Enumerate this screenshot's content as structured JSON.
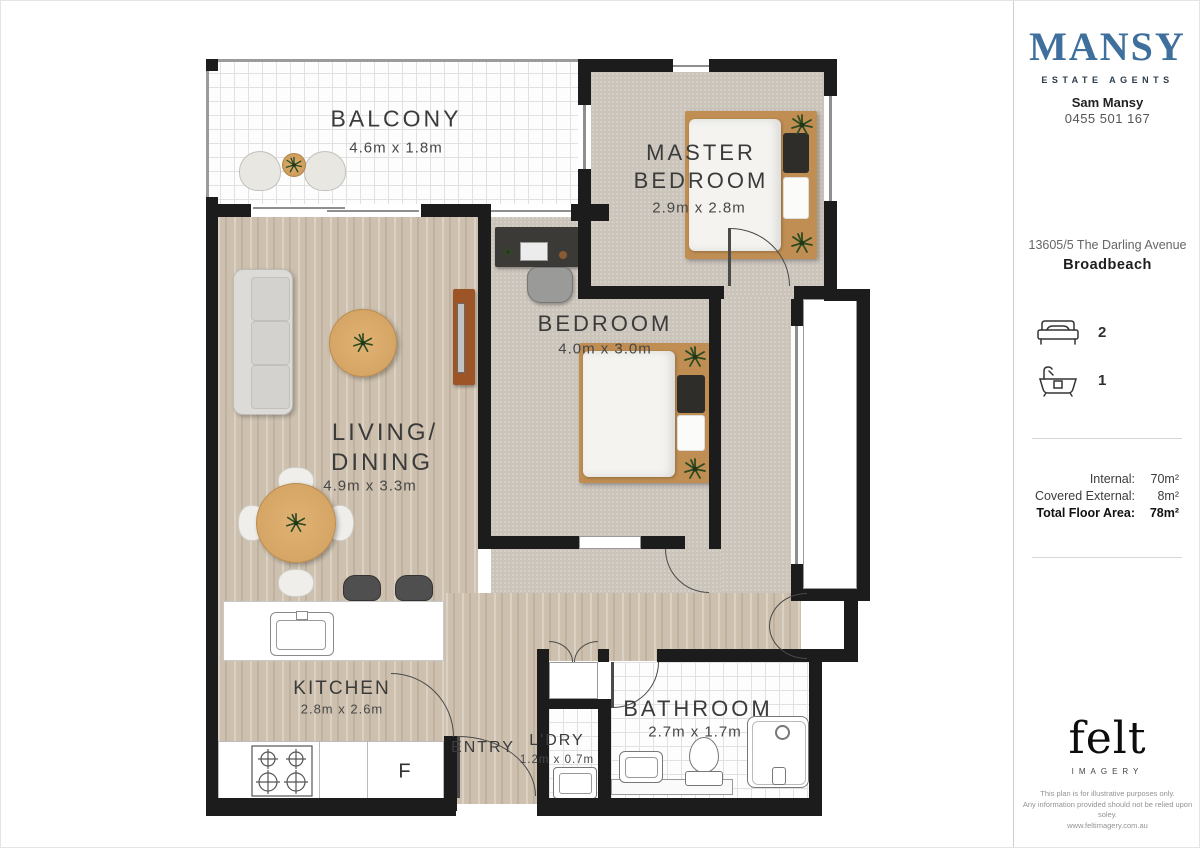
{
  "plan": {
    "rooms": {
      "balcony": {
        "name": "BALCONY",
        "dims": "4.6m x 1.8m"
      },
      "master_bedroom": {
        "name_line1": "MASTER",
        "name_line2": "BEDROOM",
        "dims": "2.9m x 2.8m"
      },
      "bedroom": {
        "name": "BEDROOM",
        "dims": "4.0m x 3.0m"
      },
      "living_dining": {
        "name_line1": "LIVING/",
        "name_line2": "DINING",
        "dims": "4.9m x 3.3m"
      },
      "kitchen": {
        "name": "KITCHEN",
        "dims": "2.8m x 2.6m"
      },
      "entry": {
        "name": "ENTRY"
      },
      "laundry": {
        "name": "L'DRY",
        "dims": "1.2m x 0.7m"
      },
      "bathroom": {
        "name": "BATHROOM",
        "dims": "2.7m x 1.7m"
      }
    },
    "appliances": {
      "fridge_label": "F"
    }
  },
  "sidebar": {
    "brand": {
      "name": "MANSY",
      "tagline": "ESTATE AGENTS"
    },
    "agent": {
      "name": "Sam Mansy",
      "phone": "0455 501 167"
    },
    "listing": {
      "address_line1": "13605/5 The Darling Avenue",
      "suburb": "Broadbeach"
    },
    "features": {
      "bedrooms": "2",
      "bathrooms": "1"
    },
    "areas": {
      "internal_label": "Internal:",
      "internal_value": "70m²",
      "external_label": "Covered External:",
      "external_value": "8m²",
      "total_label": "Total Floor Area:",
      "total_value": "78m²"
    },
    "credit": {
      "logo": "felt",
      "logo_sub": "IMAGERY",
      "disclaimer_line1": "This plan is for illustrative purposes only.",
      "disclaimer_line2": "Any information provided should not be relied upon soley.",
      "website": "www.feltimagery.com.au"
    },
    "colors": {
      "brand_blue": "#3f6f9c",
      "wall_black": "#1c1c1c"
    }
  }
}
